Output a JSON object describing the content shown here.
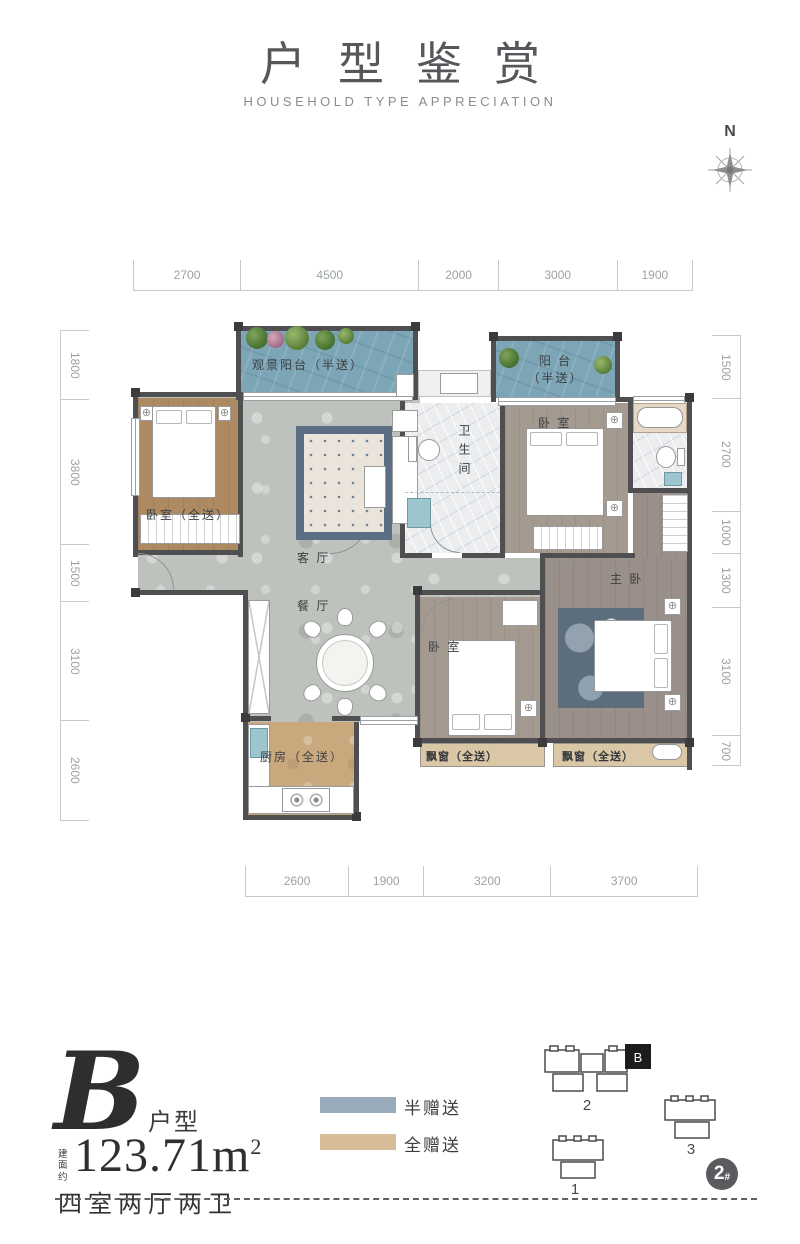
{
  "title": {
    "main": "户型鉴赏",
    "subtitle": "HOUSEHOLD TYPE APPRECIATION"
  },
  "compass": {
    "north_label": "N"
  },
  "dims": {
    "top": [
      "2700",
      "4500",
      "2000",
      "3000",
      "1900"
    ],
    "bottom": [
      "2600",
      "1900",
      "3200",
      "3700"
    ],
    "left": [
      "1800",
      "3800",
      "1500",
      "3100",
      "2600"
    ],
    "right": [
      "1500",
      "2700",
      "1000",
      "1300",
      "3100",
      "700"
    ]
  },
  "rooms": {
    "view_balcony": "观景阳台（半送）",
    "balcony": "阳 台",
    "balcony_sub": "（半送）",
    "bedroom_gift": "卧室（全送）",
    "living": "客 厅",
    "dining": "餐 厅",
    "bathroom": "卫生间",
    "bedroom_top": "卧 室",
    "master": "主 卧",
    "bedroom_bottom": "卧 室",
    "kitchen": "厨房（全送）",
    "bay1": "飘窗（全送）",
    "bay2": "飘窗（全送）"
  },
  "info": {
    "unit_letter": "B",
    "unit_suffix": "户型",
    "area_prefix": "建面约",
    "area_value": "123.71m",
    "area_sup": "2",
    "layout_text": "四室两厅两卫"
  },
  "legend": {
    "half": {
      "label": "半赠送",
      "color": "#9aabbc"
    },
    "full": {
      "label": "全赠送",
      "color": "#d6bd98"
    }
  },
  "siteplan": {
    "b1": "1",
    "b2": "2",
    "b3": "3",
    "unit_marker": "B",
    "badge_number": "2",
    "badge_suffix": "#"
  }
}
